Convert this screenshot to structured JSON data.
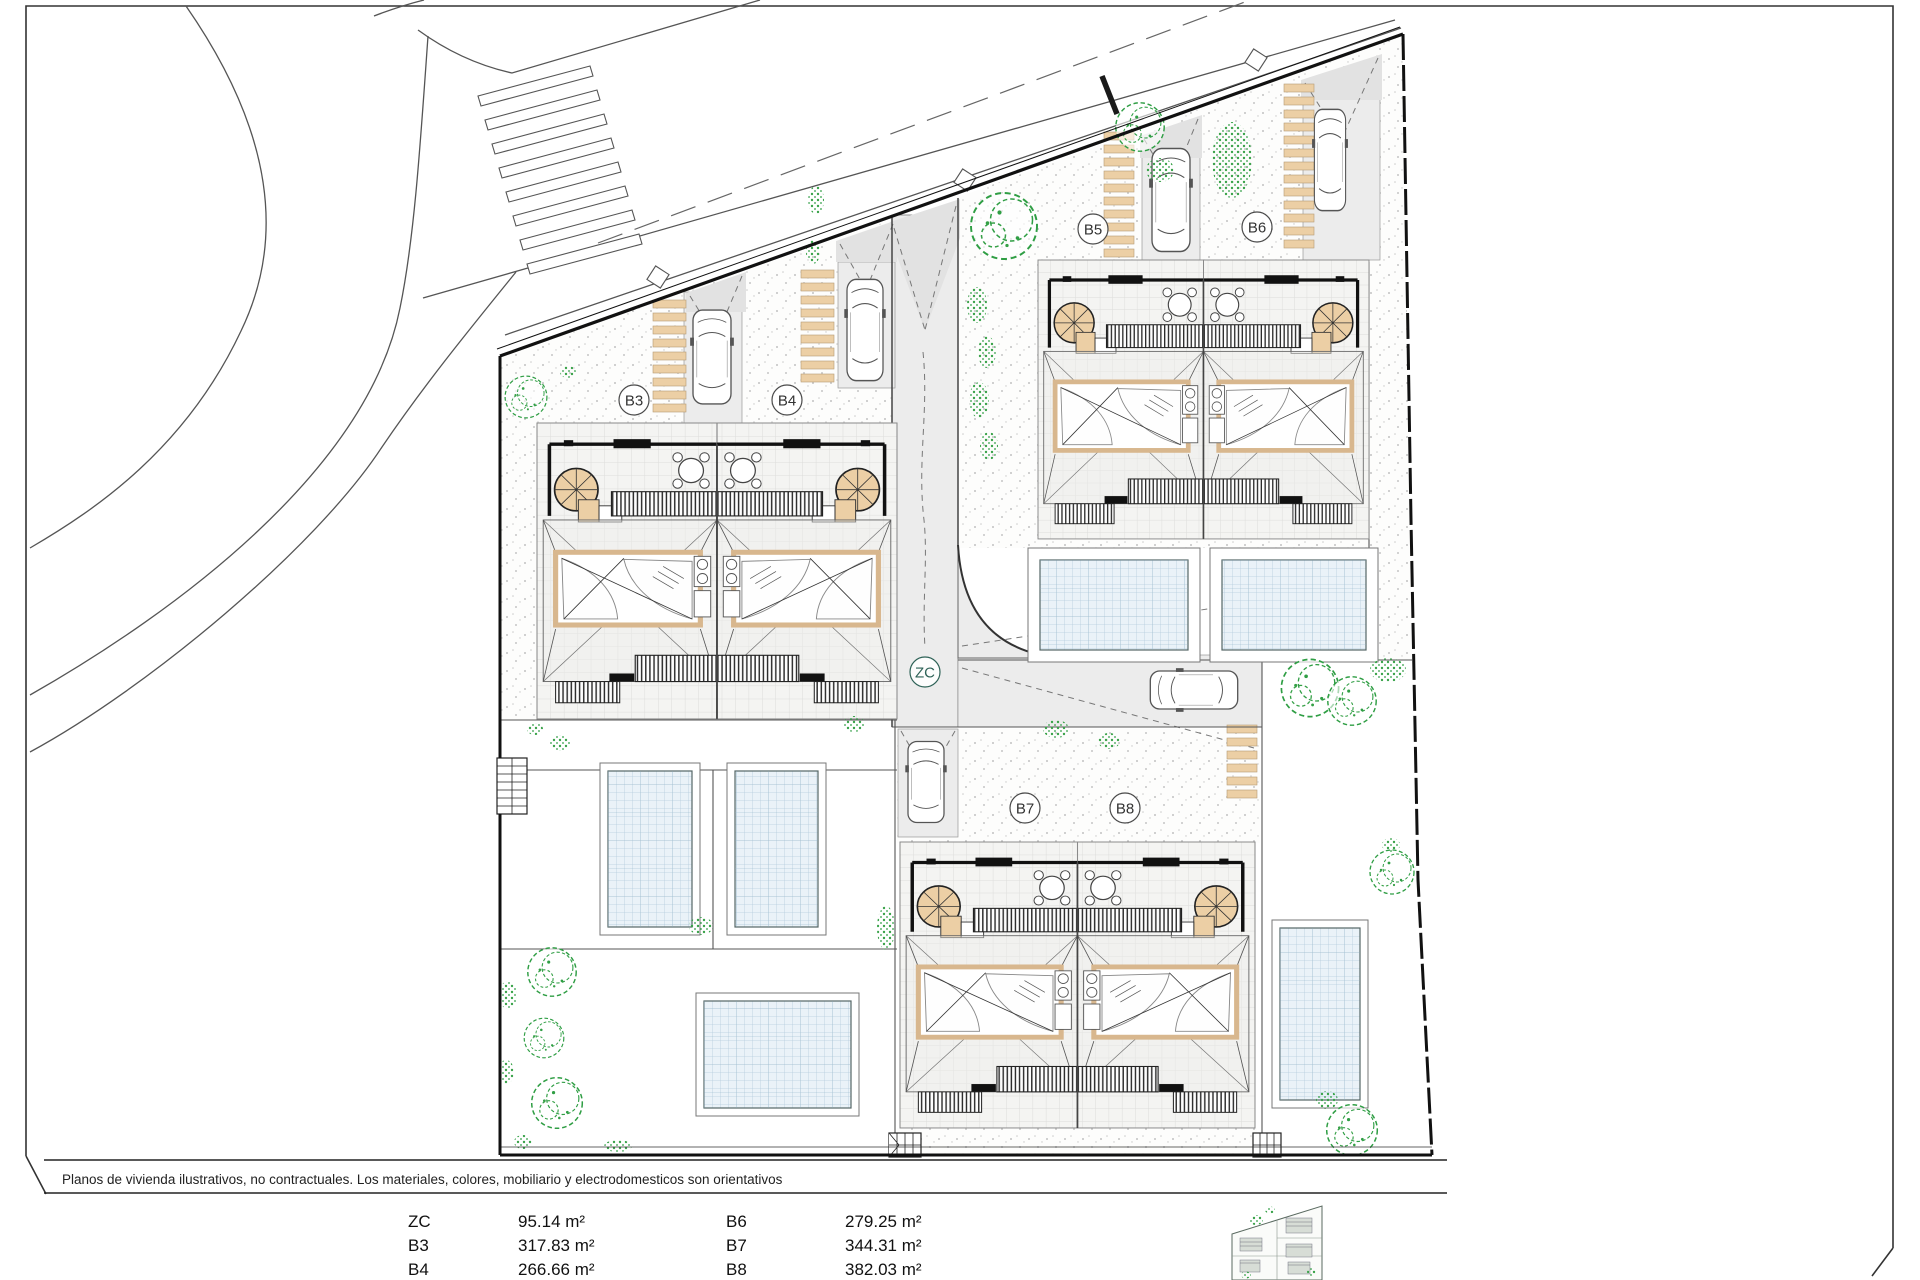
{
  "drawing": {
    "type": "residential-site-plan",
    "zone_label": "ZC",
    "unit_labels": [
      "B3",
      "B4",
      "B5",
      "B6",
      "B7",
      "B8"
    ]
  },
  "labels": {
    "b3": "B3",
    "b4": "B4",
    "b5": "B5",
    "b6": "B6",
    "b7": "B7",
    "b8": "B8",
    "zc": "ZC"
  },
  "footer": {
    "disclaimer": "Planos de vivienda ilustrativos, no contractuales. Los materiales, colores, mobiliario y electrodomesticos son orientativos"
  },
  "area_table": {
    "rows": [
      {
        "l_label": "ZC",
        "l_value": "95.14 m²",
        "r_label": "B6",
        "r_value": "279.25 m²"
      },
      {
        "l_label": "B3",
        "l_value": "317.83 m²",
        "r_label": "B7",
        "r_value": "344.31 m²"
      },
      {
        "l_label": "B4",
        "l_value": "266.66 m²",
        "r_label": "B8",
        "r_value": "382.03 m²"
      }
    ]
  },
  "symbols": {
    "car": "car-top-view-icon",
    "tree": "tree-canopy-icon",
    "spiral_stair": "spiral-staircase-icon",
    "pool": "swimming-pool-icon",
    "pergola": "pergola-slats-icon",
    "parking_stripes": "walkway-stripes-icon",
    "crosswalk": "pedestrian-crosswalk-icon",
    "manhole": "manhole-cover-icon",
    "minimap": "site-overview-minimap-icon",
    "table_chairs": "table-and-chairs-icon",
    "stairs": "exterior-stairs-icon"
  },
  "colors": {
    "tan": "#eccfa5",
    "roof_frame": "#d8b78e",
    "pool_water": "#e9f1f8",
    "pool_grid": "#b6cddd",
    "greenery": "#2f9e44",
    "driveway": "#ececec",
    "line_dark": "#1d1d1d",
    "line_mid": "#555555"
  }
}
